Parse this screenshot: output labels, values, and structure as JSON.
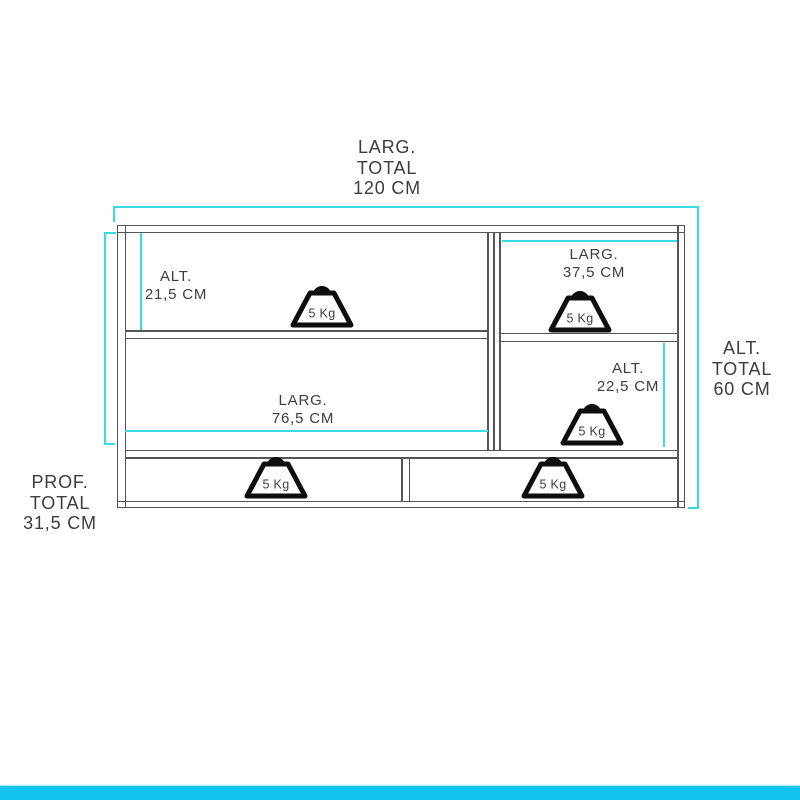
{
  "colors": {
    "line": "#555555",
    "dimension": "#38dbe4",
    "accent_bar": "#12c3ee",
    "text": "#3d3d3d",
    "weight_icon": "#0e0e0e"
  },
  "diagram": {
    "labels": {
      "total_width": [
        "LARG.",
        "TOTAL",
        "120 CM"
      ],
      "total_height": [
        "ALT.",
        "TOTAL",
        "60 CM"
      ],
      "total_depth": [
        "PROF.",
        "TOTAL",
        "31,5 CM"
      ],
      "upper_left_height": [
        "ALT.",
        "21,5 CM"
      ],
      "upper_right_width": [
        "LARG.",
        "37,5 CM"
      ],
      "lower_right_height": [
        "ALT.",
        "22,5 CM"
      ],
      "lower_left_width": [
        "LARG.",
        "76,5 CM"
      ]
    },
    "weights": [
      {
        "label": "5 Kg",
        "location": "upper-left-shelf"
      },
      {
        "label": "5 Kg",
        "location": "upper-right-shelf"
      },
      {
        "label": "5 Kg",
        "location": "lower-right-shelf"
      },
      {
        "label": "5 Kg",
        "location": "left-drawer"
      },
      {
        "label": "5 Kg",
        "location": "right-drawer"
      }
    ]
  }
}
